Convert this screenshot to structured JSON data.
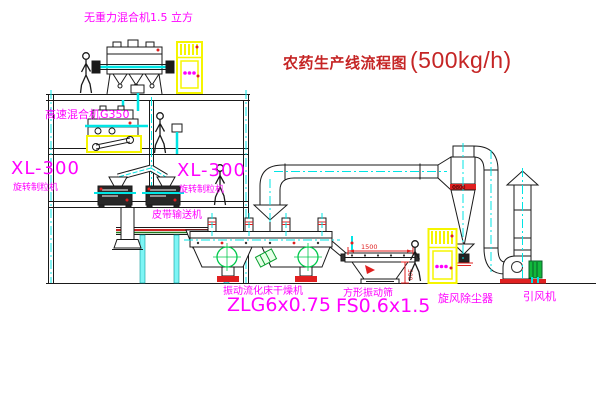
{
  "drawing": {
    "title": {
      "text": "农药生产线流程图",
      "capacity": "(500kg/h)"
    },
    "equipment_labels": {
      "gravity_mixer": "无重力混合机1.5 立方",
      "high_speed_mixer": "高速混合机G350",
      "granulator_left": {
        "model": "XL-300",
        "name": "旋转制粒机"
      },
      "granulator_right": {
        "model": "XL-300",
        "name": "旋转制粒机"
      },
      "belt_conveyor": "皮带输送机",
      "fluid_bed_dryer": {
        "name": "振动流化床干燥机",
        "model": "ZLG6x0.75"
      },
      "vibrating_screen": {
        "name": "方形振动筛",
        "model": "FS0.6x1.5"
      },
      "cyclone": "旋风除尘器",
      "induced_draft_fan": "引风机"
    },
    "dimensions": {
      "screen_length": "1500",
      "screen_height": "500",
      "cyclone_marking": "Φ800"
    },
    "colors": {
      "label_magenta": "#ff00ff",
      "title_red": "#c52525",
      "cad_yellow": "#f5f500",
      "centerline_cyan": "#00e5e5",
      "accent_green": "#00c84b",
      "accent_red": "#e02020"
    }
  }
}
